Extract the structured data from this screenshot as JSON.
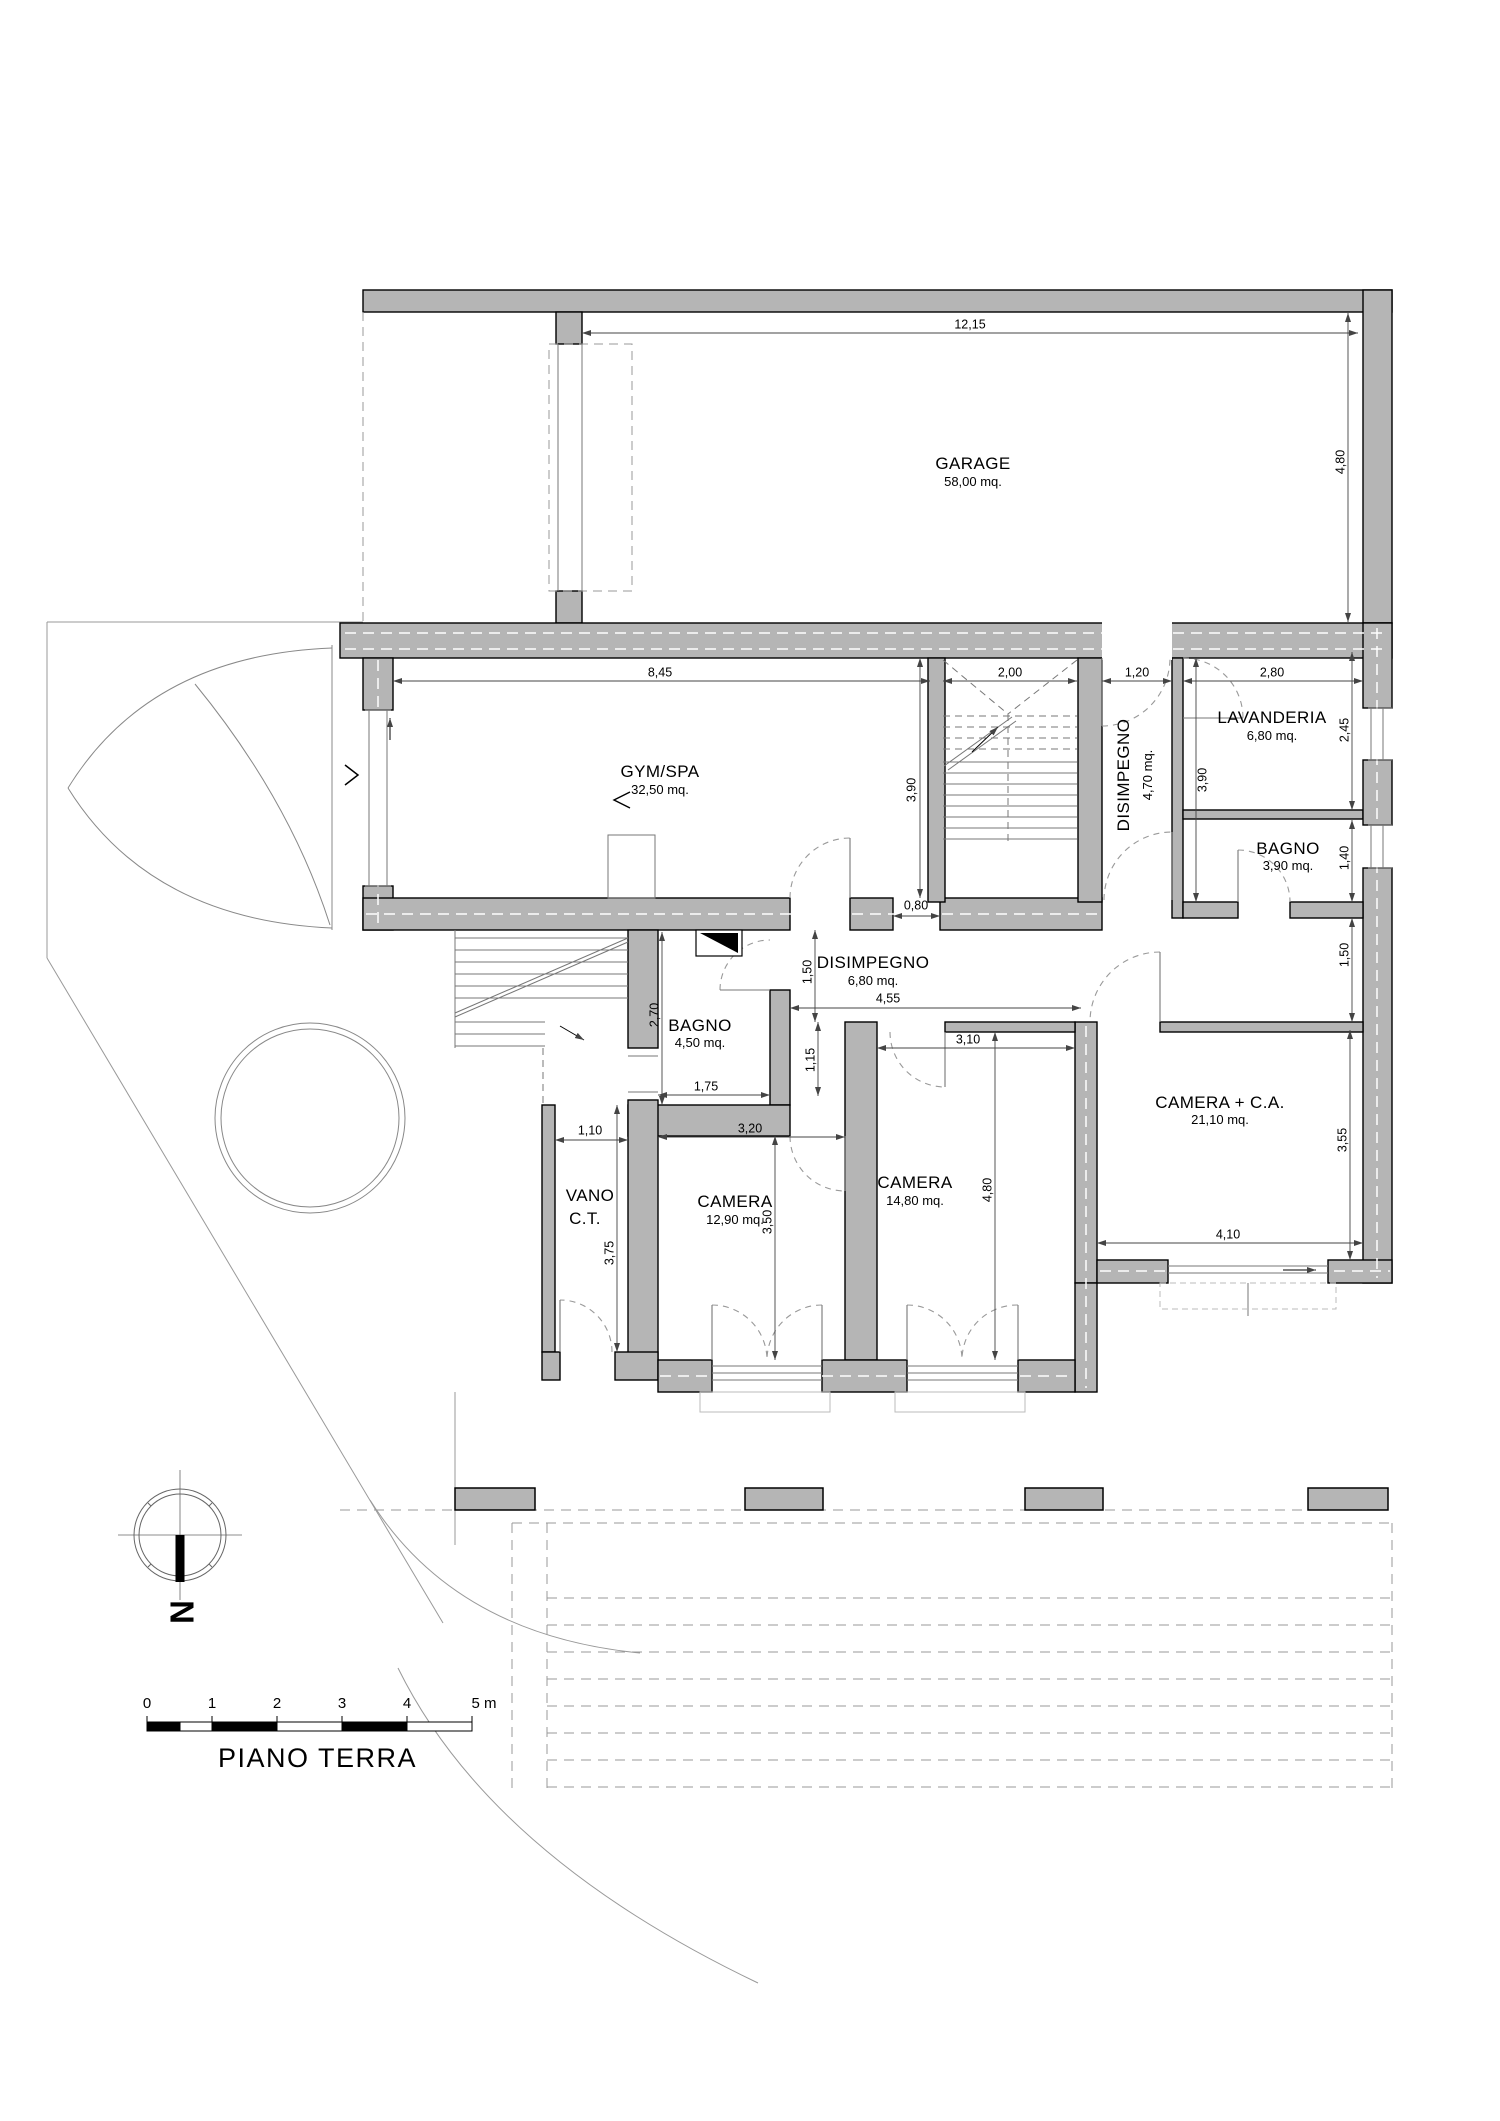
{
  "title": "PIANO TERRA",
  "compass": {
    "label": "N"
  },
  "scale_bar": {
    "labels": [
      "0",
      "1",
      "2",
      "3",
      "4",
      "5 m"
    ]
  },
  "rooms": [
    {
      "name": "GARAGE",
      "area": "58,00 mq."
    },
    {
      "name": "GYM/SPA",
      "area": "32,50 mq."
    },
    {
      "name": "LAVANDERIA",
      "area": "6,80 mq."
    },
    {
      "name": "DISIMPEGNO",
      "area": "4,70 mq."
    },
    {
      "name": "BAGNO",
      "area": "3,90 mq."
    },
    {
      "name": "DISIMPEGNO",
      "area": "6,80 mq."
    },
    {
      "name": "BAGNO",
      "area": "4,50 mq."
    },
    {
      "name": "CAMERA + C.A.",
      "area": "21,10 mq."
    },
    {
      "name": "CAMERA",
      "area": "14,80 mq."
    },
    {
      "name": "CAMERA",
      "area": "12,90 mq."
    },
    {
      "name": "VANO",
      "name2": "C.T."
    }
  ],
  "dimensions": [
    "12,15",
    "4,80",
    "8,45",
    "2,00",
    "1,20",
    "2,80",
    "3,90",
    "3,90",
    "2,45",
    "1,40",
    "1,50",
    "1,50",
    "0,80",
    "4,55",
    "3,10",
    "1,15",
    "2,70",
    "1,75",
    "3,20",
    "3,50",
    "4,80",
    "3,55",
    "4,10",
    "1,10",
    "3,75"
  ]
}
